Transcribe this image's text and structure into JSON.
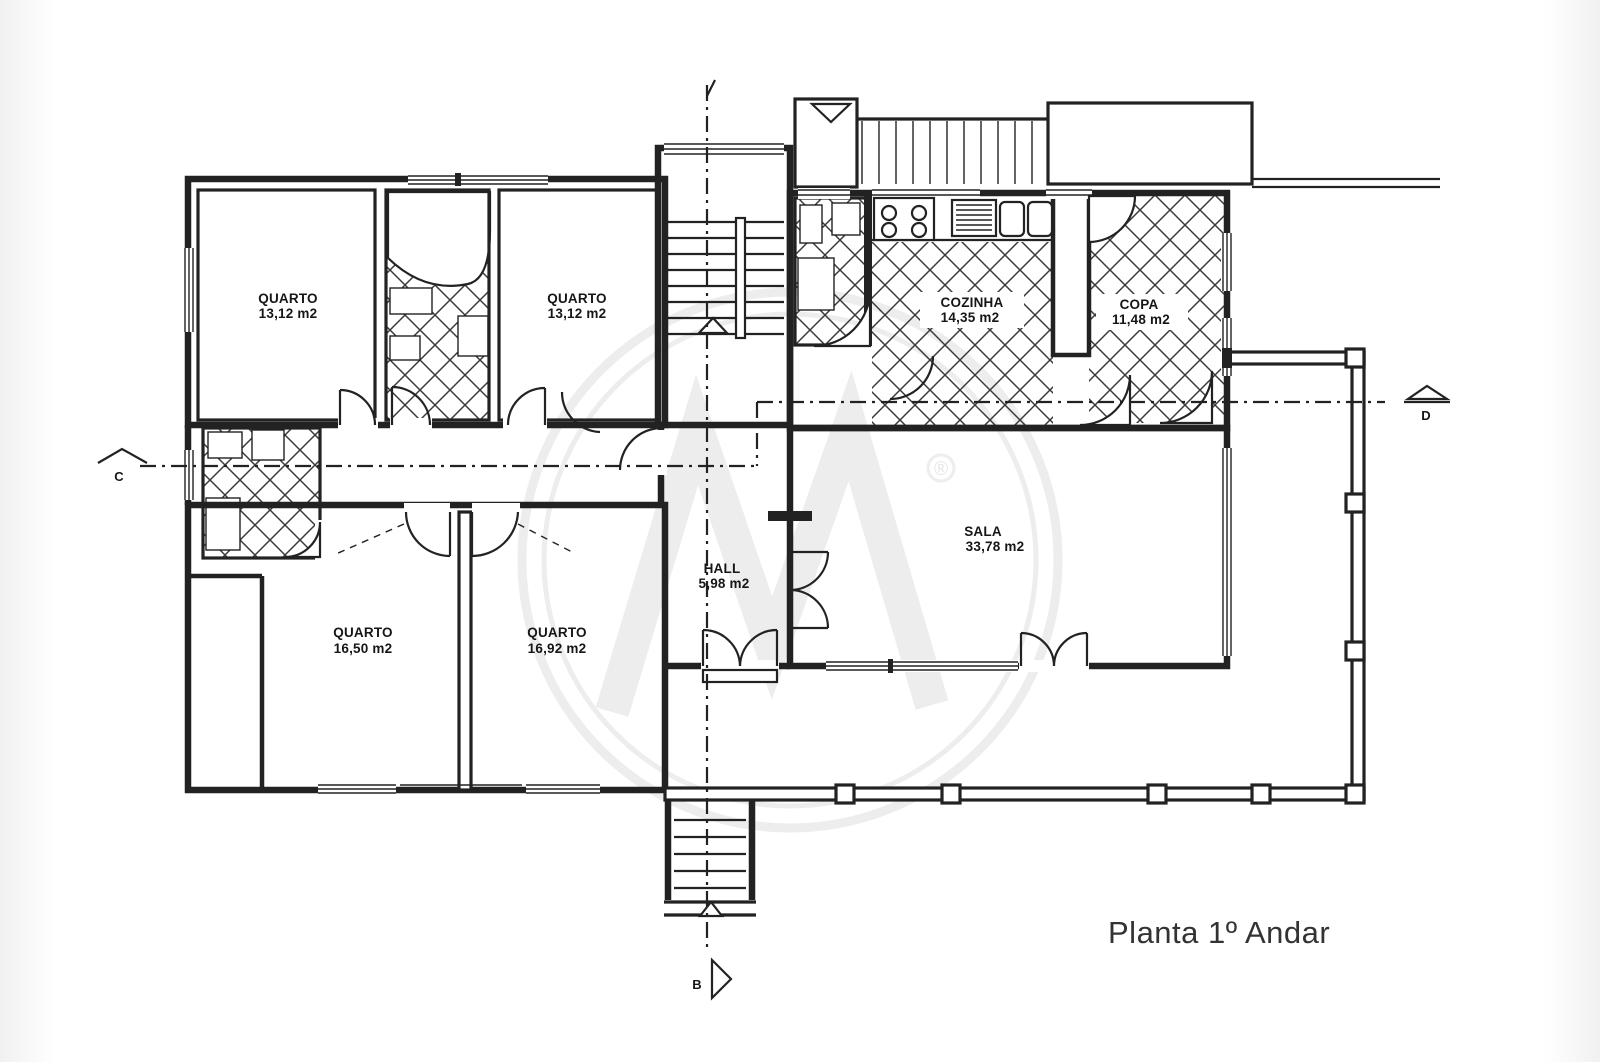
{
  "title": "Planta 1º Andar",
  "rooms": [
    {
      "name": "QUARTO",
      "area": "13,12 m2"
    },
    {
      "name": "QUARTO",
      "area": "13,12 m2"
    },
    {
      "name": "COZINHA",
      "area": "14,35 m2"
    },
    {
      "name": "COPA",
      "area": "11,48 m2"
    },
    {
      "name": "HALL",
      "area": "5,98 m2"
    },
    {
      "name": "SALA",
      "area": "33,78 m2"
    },
    {
      "name": "QUARTO",
      "area": "16,50 m2"
    },
    {
      "name": "QUARTO",
      "area": "16,92 m2"
    }
  ],
  "section_markers": {
    "left": "C",
    "right": "D",
    "bottom": "B"
  },
  "watermark": {
    "registered_symbol": "®"
  },
  "colors": {
    "ink": "#222222",
    "paper": "#ffffff",
    "watermark": "#ededed",
    "title_text": "#333333"
  }
}
